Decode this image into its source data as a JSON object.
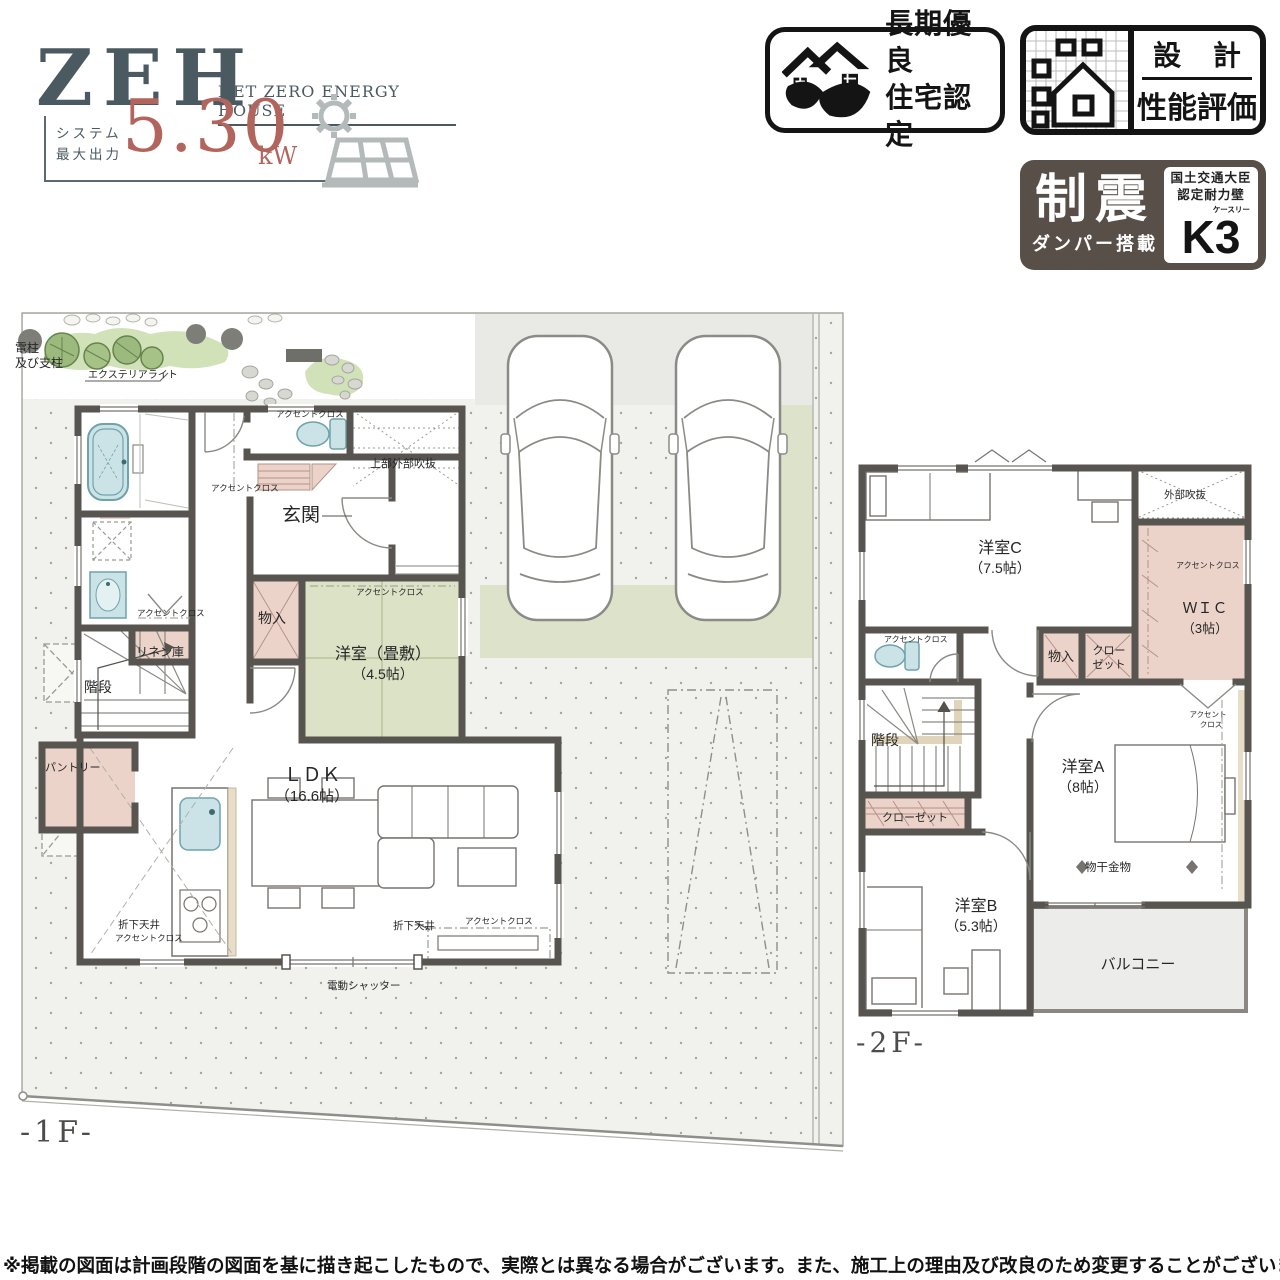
{
  "zeh": {
    "title": "ZEH",
    "subtitle": "NET ZERO ENERGY HOUSE",
    "label_line1": "システム",
    "label_line2": "最大出力",
    "value": "5.30",
    "unit": "kW"
  },
  "badges": {
    "chouki": {
      "line1": "長期優良",
      "line2": "住宅認定"
    },
    "sekkei": {
      "top": "設 計",
      "bottom": "性能評価"
    },
    "seishin": {
      "big": "制震",
      "sub": "ダンパー搭載",
      "cert_line1": "国土交通大臣",
      "cert_line2": "認定耐力壁",
      "k3_k": "K",
      "k3_3": "3",
      "k3_small": "ケースリー"
    }
  },
  "palette": {
    "wall": "#585450",
    "tatami_green": "#dbe2c6",
    "closet_pink": "#ecd3ca",
    "fixture_blue": "#cbe3e7",
    "lawn_green": "#dde2ca",
    "garden_green": "#a7c287",
    "site_gray": "#f1f1ee",
    "driveway_gray": "#e9e9e6",
    "balcony_gray": "#ececea",
    "accent_wood": "#e8ddc6",
    "zeh_slate": "#4b5a61",
    "zeh_rose": "#b2655c",
    "panel_gray": "#b4b9b9",
    "badge_black": "#141414",
    "seishin_bg": "#584f49"
  },
  "floor1": {
    "labels": [
      {
        "n": "label-utility-pole-1",
        "t": "電柱",
        "x": 15,
        "y": 352,
        "s": 12
      },
      {
        "n": "label-utility-pole-2",
        "t": "及び支柱",
        "x": 15,
        "y": 367,
        "s": 12
      },
      {
        "n": "label-exterior-light",
        "t": "エクステリアライト",
        "x": 88,
        "y": 378,
        "s": 10
      },
      {
        "n": "label-accent-cloth-toilet-1f",
        "t": "アクセントクロス",
        "x": 276,
        "y": 417,
        "s": 8.5
      },
      {
        "n": "label-upper-outer-void",
        "t": "上部外部吹抜",
        "x": 370,
        "y": 467,
        "s": 11
      },
      {
        "n": "label-accent-cloth-hall-1f",
        "t": "アクセントクロス",
        "x": 211,
        "y": 491,
        "s": 8.5
      },
      {
        "n": "label-genkan",
        "t": "玄関",
        "x": 301,
        "y": 521,
        "s": 19,
        "a": "m"
      },
      {
        "n": "label-monoire-1f",
        "t": "物入",
        "x": 272,
        "y": 623,
        "s": 14,
        "a": "m"
      },
      {
        "n": "label-accent-cloth-tatami",
        "t": "アクセントクロス",
        "x": 356,
        "y": 595,
        "s": 8.5
      },
      {
        "n": "label-tatami-room",
        "t": "洋室（畳敷）",
        "x": 383,
        "y": 659,
        "s": 16,
        "a": "m"
      },
      {
        "n": "label-tatami-size",
        "t": "（4.5帖）",
        "x": 383,
        "y": 679,
        "s": 14,
        "a": "m"
      },
      {
        "n": "label-accent-cloth-wash",
        "t": "アクセントクロス",
        "x": 137,
        "y": 616,
        "s": 8.5
      },
      {
        "n": "label-linen",
        "t": "リネン庫",
        "x": 136,
        "y": 656,
        "s": 12
      },
      {
        "n": "label-kaidan-1f",
        "t": "階段",
        "x": 84,
        "y": 692,
        "s": 14
      },
      {
        "n": "label-pantry",
        "t": "パントリー",
        "x": 45,
        "y": 771,
        "s": 11
      },
      {
        "n": "label-ldk",
        "t": "ＬＤＫ",
        "x": 312,
        "y": 781,
        "s": 19,
        "a": "m"
      },
      {
        "n": "label-ldk-size",
        "t": "（16.6帖）",
        "x": 312,
        "y": 801,
        "s": 15,
        "a": "m"
      },
      {
        "n": "label-orishita-kitchen",
        "t": "折下天井",
        "x": 118,
        "y": 928,
        "s": 10.5
      },
      {
        "n": "label-accent-kitchen",
        "t": "アクセントクロス",
        "x": 115,
        "y": 941,
        "s": 8.5
      },
      {
        "n": "label-orishita-living",
        "t": "折下天井",
        "x": 393,
        "y": 929,
        "s": 10.5
      },
      {
        "n": "label-accent-living",
        "t": "アクセントクロス",
        "x": 465,
        "y": 924,
        "s": 8.5
      },
      {
        "n": "label-dendo-shutter",
        "t": "電動シャッター",
        "x": 327,
        "y": 989,
        "s": 10.5
      },
      {
        "n": "floor1-title",
        "t": "-1F-",
        "x": 20,
        "y": 1142,
        "s": 30,
        "f": "serif"
      }
    ]
  },
  "floor2": {
    "labels": [
      {
        "n": "label-outer-void-2f",
        "t": "外部吹抜",
        "x": 1164,
        "y": 498,
        "s": 10.5
      },
      {
        "n": "label-yoshitsu-c",
        "t": "洋室C",
        "x": 1000,
        "y": 553,
        "s": 16,
        "a": "m"
      },
      {
        "n": "label-yoshitsu-c-size",
        "t": "（7.5帖）",
        "x": 1000,
        "y": 573,
        "s": 14,
        "a": "m"
      },
      {
        "n": "label-accent-wic",
        "t": "アクセントクロス",
        "x": 1176,
        "y": 568,
        "s": 8
      },
      {
        "n": "label-wic",
        "t": "ＷＩＣ",
        "x": 1205,
        "y": 613,
        "s": 15,
        "a": "m"
      },
      {
        "n": "label-wic-size",
        "t": "（3帖）",
        "x": 1205,
        "y": 633,
        "s": 13,
        "a": "m"
      },
      {
        "n": "label-monoire-2f",
        "t": "物入",
        "x": 1061,
        "y": 661,
        "s": 13,
        "a": "m"
      },
      {
        "n": "label-closet-2f-line1",
        "t": "クロー",
        "x": 1109,
        "y": 654,
        "s": 11,
        "a": "m"
      },
      {
        "n": "label-closet-2f-line2",
        "t": "ゼット",
        "x": 1109,
        "y": 668,
        "s": 11,
        "a": "m"
      },
      {
        "n": "label-accent-toilet-2f",
        "t": "アクセントクロス",
        "x": 884,
        "y": 642,
        "s": 8
      },
      {
        "n": "label-kaidan-2f",
        "t": "階段",
        "x": 871,
        "y": 745,
        "s": 14
      },
      {
        "n": "label-closet-2f-lower",
        "t": "クローゼット",
        "x": 915,
        "y": 821,
        "s": 11,
        "a": "m"
      },
      {
        "n": "label-yoshitsu-a",
        "t": "洋室A",
        "x": 1083,
        "y": 772,
        "s": 16,
        "a": "m"
      },
      {
        "n": "label-yoshitsu-a-size",
        "t": "（8帖）",
        "x": 1083,
        "y": 792,
        "s": 14,
        "a": "m"
      },
      {
        "n": "label-accent-a-line1",
        "t": "アクセント",
        "x": 1208,
        "y": 717,
        "s": 7.5,
        "a": "m"
      },
      {
        "n": "label-accent-a-line2",
        "t": "クロス",
        "x": 1211,
        "y": 727,
        "s": 7.5,
        "a": "m"
      },
      {
        "n": "label-monohoshi",
        "t": "物干金物",
        "x": 1108,
        "y": 871,
        "s": 11.5,
        "a": "m"
      },
      {
        "n": "label-yoshitsu-b",
        "t": "洋室B",
        "x": 976,
        "y": 911,
        "s": 16,
        "a": "m"
      },
      {
        "n": "label-yoshitsu-b-size",
        "t": "（5.3帖）",
        "x": 976,
        "y": 931,
        "s": 14,
        "a": "m"
      },
      {
        "n": "label-balcony",
        "t": "バルコニー",
        "x": 1138,
        "y": 969,
        "s": 15,
        "a": "m"
      },
      {
        "n": "floor2-title",
        "t": "-2F-",
        "x": 856,
        "y": 1052,
        "s": 28,
        "f": "serif"
      }
    ]
  },
  "disclaimer": "※掲載の図面は計画段階の図面を基に描き起こしたもので、実際とは異なる場合がございます。また、施工上の理由及び改良のため変更することがございます。"
}
